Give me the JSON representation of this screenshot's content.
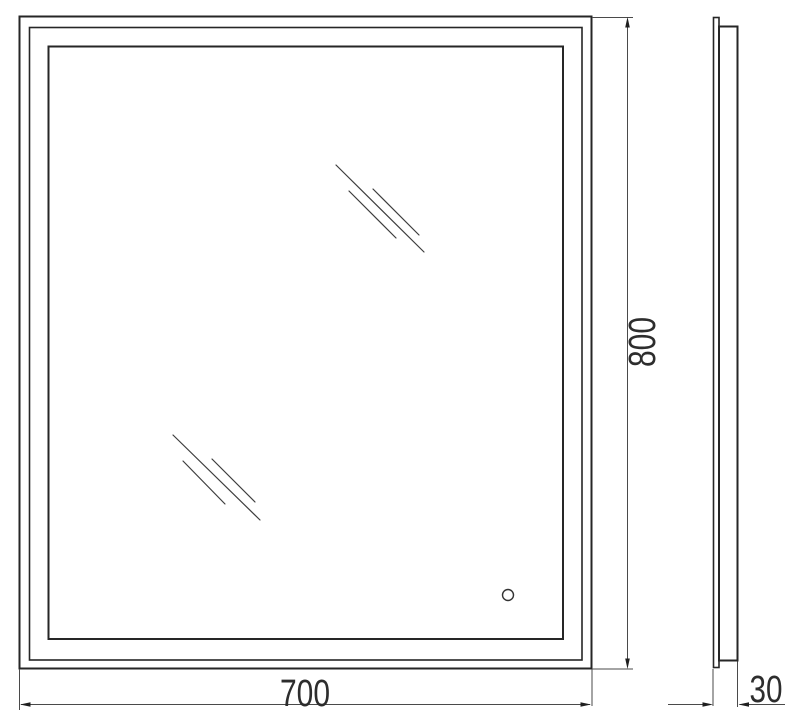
{
  "drawing": {
    "type": "technical-dimension-drawing",
    "subject": "rectangular illuminated mirror, front view and side view"
  },
  "dimensions": {
    "width": "700",
    "height": "800",
    "depth": "30"
  },
  "icons": {
    "reflection_marks": "glass-shine-icon",
    "sensor": "touch-sensor-icon",
    "arrows": "dimension-arrowhead-icon"
  },
  "colors": {
    "outline": "#262626",
    "dimension_lines": "#4a4a4a",
    "arrowheads": "#1f1f1f",
    "label_text": "#2d2d2d",
    "background": "#ffffff"
  }
}
